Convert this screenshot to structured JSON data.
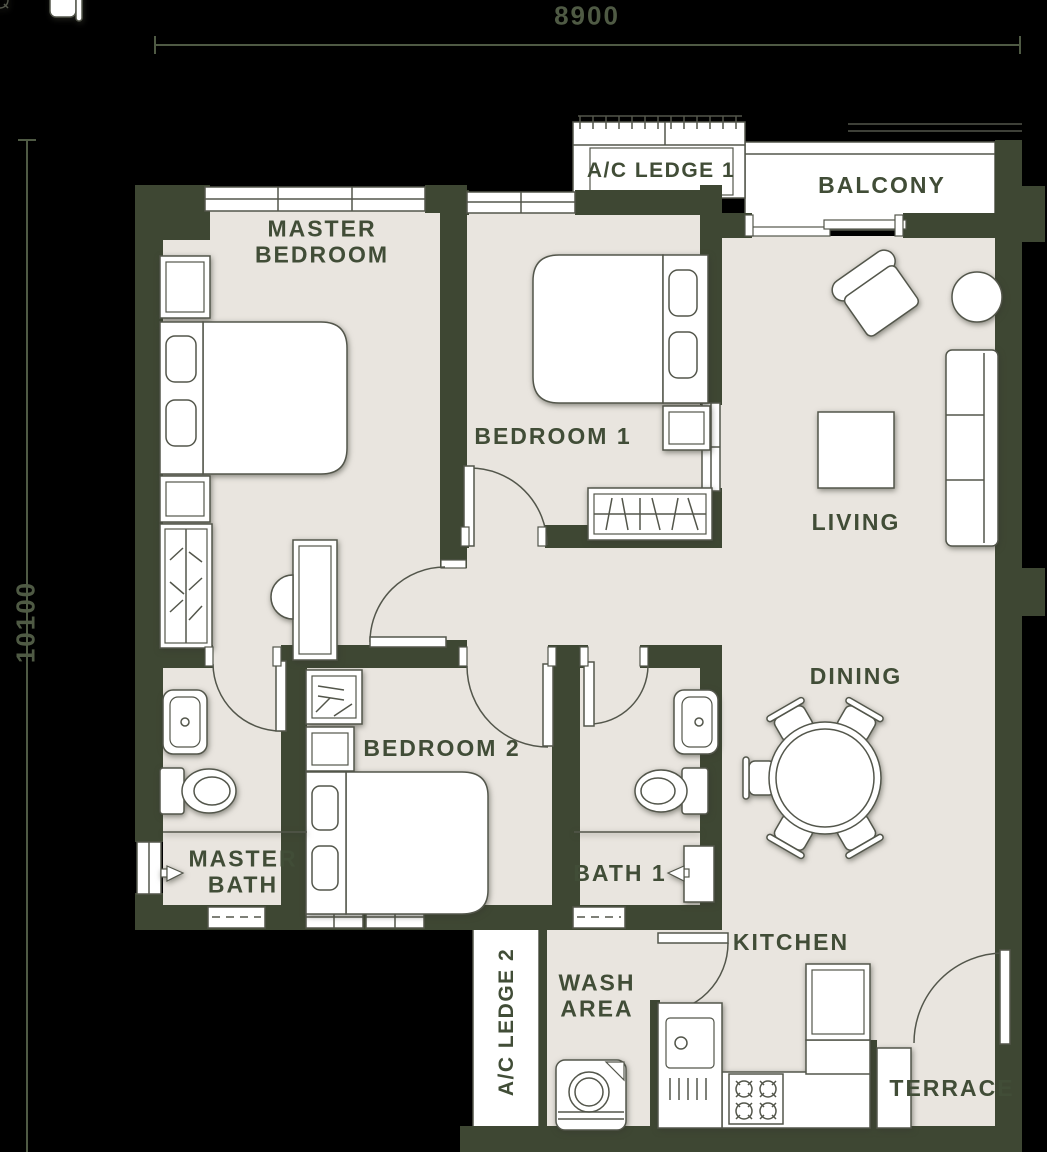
{
  "floor_plan": {
    "dimensions": {
      "width": "8900",
      "height": "10100"
    },
    "rooms": {
      "ac_ledge_1": "A/C LEDGE 1",
      "balcony": "BALCONY",
      "master_bedroom": [
        "MASTER",
        "BEDROOM"
      ],
      "bedroom_1": "BEDROOM 1",
      "living": "LIVING",
      "dining": "DINING",
      "bedroom_2": "BEDROOM 2",
      "master_bath": [
        "MASTER",
        "BATH"
      ],
      "bath_1": "BATH 1",
      "kitchen": "KITCHEN",
      "wash_area": [
        "WASH",
        "AREA"
      ],
      "ac_ledge_2": "A/C LEDGE 2",
      "terrace": "TERRACE"
    },
    "colors": {
      "background": "#000000",
      "wall": "#3e4733",
      "floor": "#e9e5df",
      "fixture_fill": "#ffffff",
      "fixture_line": "#53564b",
      "label": "#414d37",
      "dimension": "#4f5a44"
    }
  }
}
